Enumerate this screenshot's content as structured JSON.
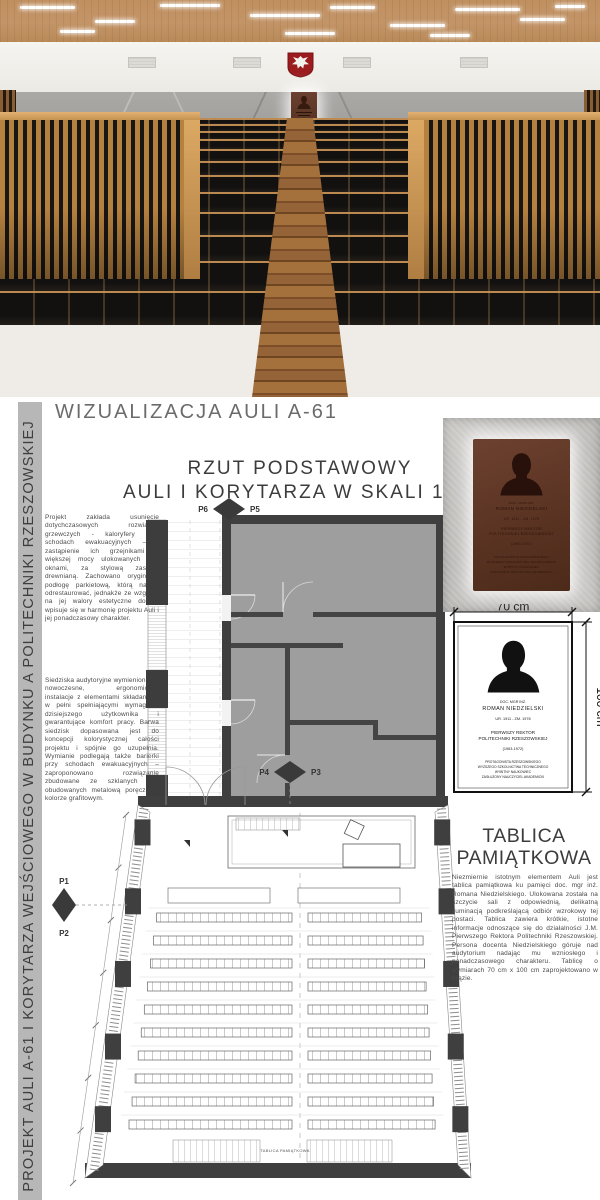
{
  "sidebar": {
    "title": "PROJEKT AULI A-61 I KORYTARZA WEJŚCIOWEGO W BUDYNKU A POLITECHNIKI RZESZOWSKIEJ"
  },
  "headings": {
    "visualization": "WIZUALIZACJA AULI A-61",
    "plan_line1": "RZUT PODSTAWOWY",
    "plan_line2": "AULI I KORYTARZA W SKALI 1:50",
    "memorial_line1": "TABLICA",
    "memorial_line2": "PAMIĄTKOWA"
  },
  "paragraphs": {
    "p1": "Projekt zakłada usunięcie dotychczasowych rozwiązań grzewczych - kaloryfery przy schodach ewakuacyjnych – i zastąpienie ich grzejnikami o większej mocy ulokowanych pod oknami, za stylową zasłoną drewnianą. Zachowano oryginalną podłogę parkietową, którą należy odrestaurować, jednakże ze względu na jej walory estetyczne dobrze wpisuje się w harmonię projektu Auli i jej ponadczasowy charakter.",
    "p2": "Siedziska audytoryjne wymieniono na nowoczesne, ergonomiczne instalacje z elementami składanymi, w pełni spełniającymi wymagania dzisiejszego użytkownika i gwarantujące komfort pracy. Barwa siedzisk dopasowana jest do koncepcji kolorystycznej całości projektu i spójnie go uzupełnia. Wymianie podlegają także barierki przy schodach ewakuacyjnych – zaproponowano rozwiązanie zbudowane ze szklanych tafli obudowanych metalową poręczą w kolorze grafitowym.",
    "p3": "Niezmiernie istotnym elementem Auli jest tablica pamiątkowa ku pamięci doc. mgr inż. Romana Niedzielskiego. Ulokowana została na szczycie sali z odpowiednią, delikatną iluminacją podkreślającą odbiór wzrokowy tej postaci. Tablica zawiera krótkie, istotne informacje odnoszące się do działalności J.M. Pierwszego Rektora Politechniki Rzeszowskiej. Persona docenta Niedzielskiego góruje nad audytorium nadając mu wzniosłego i ponadczasowego charakteru. Tablicę o wymiarach 70 cm x 100 cm zaprojektowano w brązie."
  },
  "plan": {
    "markers": {
      "p1": "P1",
      "p2": "P2",
      "p3": "P3",
      "p4": "P4",
      "p5": "P5",
      "p6": "P6"
    },
    "back_wall_label": "TABLICA PAMIĄTKOWA"
  },
  "plaque": {
    "dim_width": "70 cm",
    "dim_height": "100 cm",
    "lines": [
      "DOC. MGR INŻ.",
      "ROMAN NIEDZIELSKI",
      "UR. 1911 - ZM. 1978",
      "PIERWSZY REKTOR",
      "POLITECHNIKI RZESZOWSKIEJ",
      "(1963-1972)",
      "PROTAGONISTA RZESZOWSKIEGO",
      "WYŻSZEGO SZKOLNICTWA TECHNICZNEGO",
      "WYBITNY NAUKOWIEC",
      "ZASŁUŻONY NAUCZYCIEL AKADEMICKI"
    ]
  },
  "colors": {
    "wood_accent": "#b5813f",
    "plaque_brown": "#5a3322",
    "plan_wall": "#3f3f3f",
    "plan_fill": "#9e9e9e",
    "eagle_red": "#9b1b1e",
    "sidebar_gray": "#b7b7b7"
  }
}
